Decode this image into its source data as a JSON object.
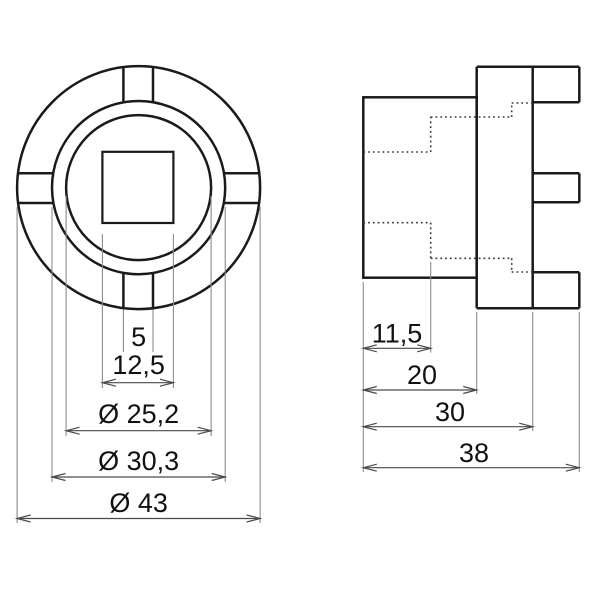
{
  "front_view": {
    "slot_width": "5",
    "square_drive": "12,5",
    "bore_diameter": "Ø 25,2",
    "ring_diameter": "Ø 30,3",
    "outer_diameter": "Ø 43"
  },
  "side_view": {
    "pocket_depth": "11,5",
    "sleeve_length": "20",
    "length_to_tabs": "30",
    "overall_length": "38"
  },
  "colors": {
    "outline": "#1a1a1a",
    "dim-line": "#4a4a4a",
    "ext-line": "#8c8c8c",
    "hidden-line": "#3c3c3c",
    "label": "#111111",
    "background": "#ffffff"
  }
}
